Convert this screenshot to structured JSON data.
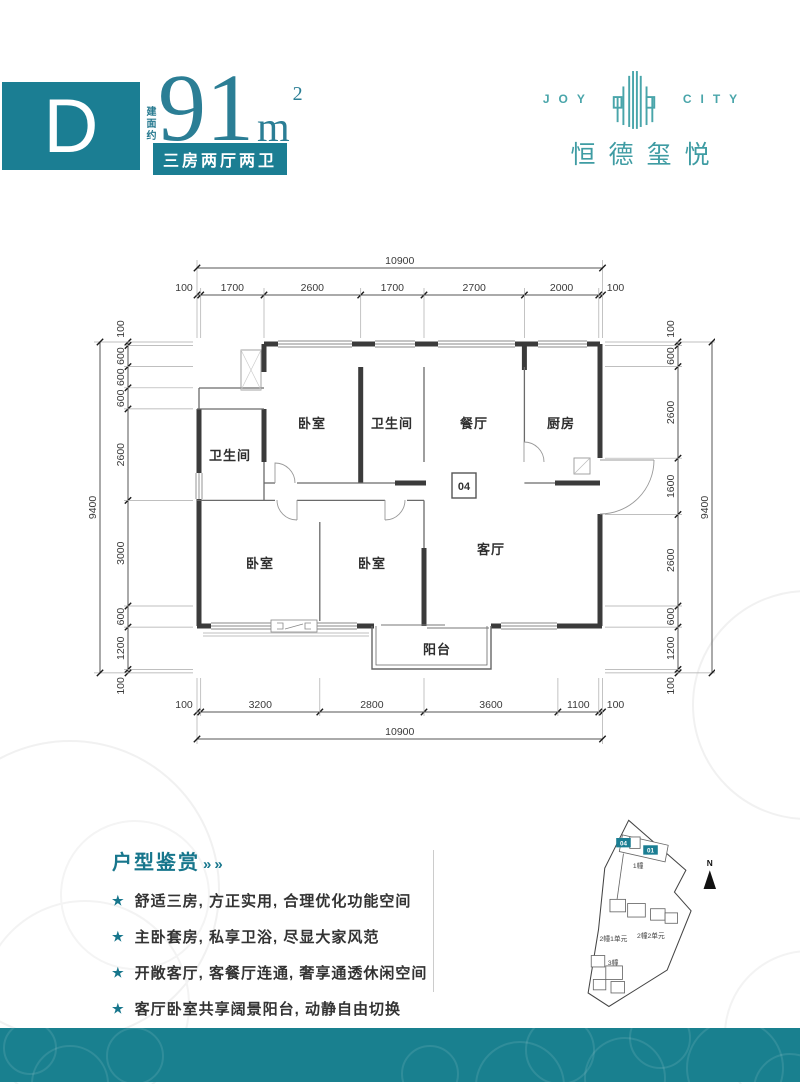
{
  "unit": {
    "letter": "D",
    "area_prefix": "建面约",
    "area_value": "91",
    "area_unit": "m",
    "area_sup": "2",
    "layout": "三房两厅两卫"
  },
  "brand": {
    "word_left": "JOY",
    "word_right": "CITY",
    "name": "恒德玺悦"
  },
  "floorplan": {
    "unit_number": "04",
    "rooms": {
      "bedroom_top": "卧室",
      "bath_top": "卫生间",
      "dining": "餐厅",
      "kitchen": "厨房",
      "bath_left": "卫生间",
      "bedroom_left": "卧室",
      "bedroom_mid": "卧室",
      "living": "客厅",
      "balcony": "阳台"
    },
    "dims": {
      "top": {
        "total": "10900",
        "segments": [
          "100",
          "1700",
          "2600",
          "1700",
          "2700",
          "2000",
          "100"
        ]
      },
      "bottom": {
        "total": "10900",
        "segments": [
          "100",
          "3200",
          "2800",
          "3600",
          "1100",
          "100"
        ]
      },
      "left": {
        "total": "9400",
        "segments": [
          "100",
          "600",
          "600",
          "600",
          "2600",
          "3000",
          "600",
          "1200",
          "100"
        ]
      },
      "right": {
        "total": "9400",
        "segments": [
          "100",
          "600",
          "2600",
          "1600",
          "2600",
          "600",
          "1200",
          "100"
        ]
      }
    }
  },
  "features": {
    "title": "户型鉴赏",
    "marker": "»",
    "star": "★",
    "items": [
      "舒适三房, 方正实用, 合理优化功能空间",
      "主卧套房, 私享卫浴, 尽显大家风范",
      "开敞客厅, 客餐厅连通, 奢享通透休闲空间",
      "客厅卧室共享阔景阳台, 动静自由切换"
    ]
  },
  "siteplan": {
    "unit_a": "04",
    "unit_b": "01",
    "building1": "1幢",
    "building2u1": "2幢1单元",
    "building2u2": "2幢2单元",
    "building3": "3幢",
    "north": "N"
  },
  "colors": {
    "primary_teal": "#1b7e93",
    "logo_teal": "#49a5aa",
    "numeral_teal": "#2b7e95",
    "footer_teal": "#19808f",
    "wall_dark": "#3b3b3b"
  }
}
